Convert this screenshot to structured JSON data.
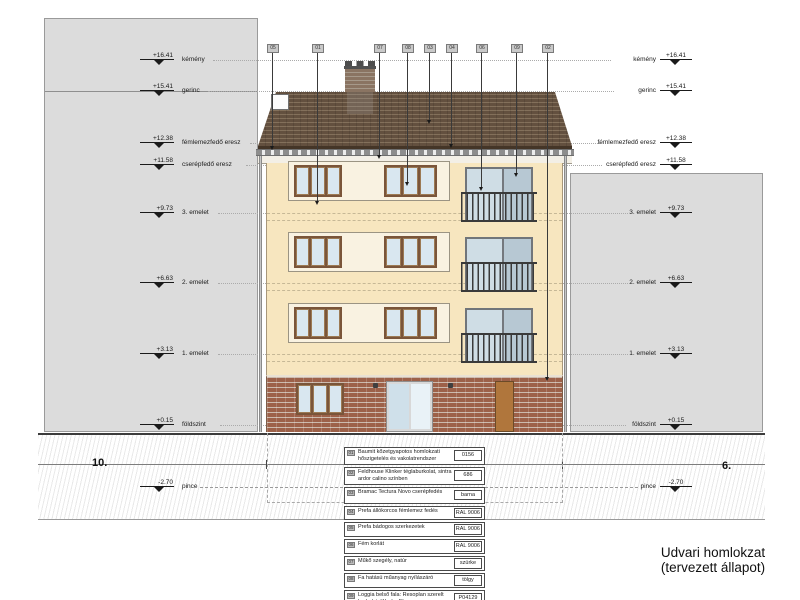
{
  "drawing": {
    "title_line1": "Udvari homlokzat",
    "title_line2": "(tervezett állapot)",
    "axis_left": "10.",
    "axis_right": "6."
  },
  "elevations": [
    {
      "value": "+16.41",
      "label": "kémény"
    },
    {
      "value": "+15.41",
      "label": "gerinc"
    },
    {
      "value": "+12.38",
      "label": "fémlemezfedő eresz"
    },
    {
      "value": "+11.58",
      "label": "cserépfedő eresz"
    },
    {
      "value": "+9.73",
      "label": "3. emelet"
    },
    {
      "value": "+6.63",
      "label": "2. emelet"
    },
    {
      "value": "+3.13",
      "label": "1. emelet"
    },
    {
      "value": "+0.15",
      "label": "földszint"
    },
    {
      "value": "-2.70",
      "label": "pince"
    }
  ],
  "callouts": [
    {
      "num": "05"
    },
    {
      "num": "01"
    },
    {
      "num": "07"
    },
    {
      "num": "08"
    },
    {
      "num": "03"
    },
    {
      "num": "04"
    },
    {
      "num": "06"
    },
    {
      "num": "09"
    },
    {
      "num": "02"
    }
  ],
  "legend": [
    {
      "num": "01",
      "desc": "Baumit kőzetgyapotos homlokzati hőszigetelés és vakolatrendszer",
      "value": "0156"
    },
    {
      "num": "02",
      "desc": "Feldhouse Klinker téglaburkolat, sintra ardor calino színben",
      "value": "686"
    },
    {
      "num": "03",
      "desc": "Bramac Tectura Novo cserépfedés",
      "value": "barna"
    },
    {
      "num": "04",
      "desc": "Prefa állókorcos fémlemez fedés",
      "value": "RAL 9006"
    },
    {
      "num": "05",
      "desc": "Prefa bádogos szerkezetek",
      "value": "RAL 9006"
    },
    {
      "num": "06",
      "desc": "Fém korlát",
      "value": "RAL 9006"
    },
    {
      "num": "07",
      "desc": "Műkő szegély, natúr",
      "value": "szürke"
    },
    {
      "num": "08",
      "desc": "Fa hatású műanyag nyílászáró",
      "value": "tölgy"
    },
    {
      "num": "09",
      "desc": "Loggia belső fala: Resoplan szerelt burkolat, Washy Elm",
      "value": "P04129"
    }
  ],
  "colors": {
    "facade": "#f7e6bf",
    "roof": "#5d4a3a",
    "brick_plinth": "#a3654c",
    "neighbor_block": "#dcdcdc",
    "glass": "#d9e7f0",
    "railing": "#3a3a3a",
    "wood_door": "#b0763c"
  }
}
